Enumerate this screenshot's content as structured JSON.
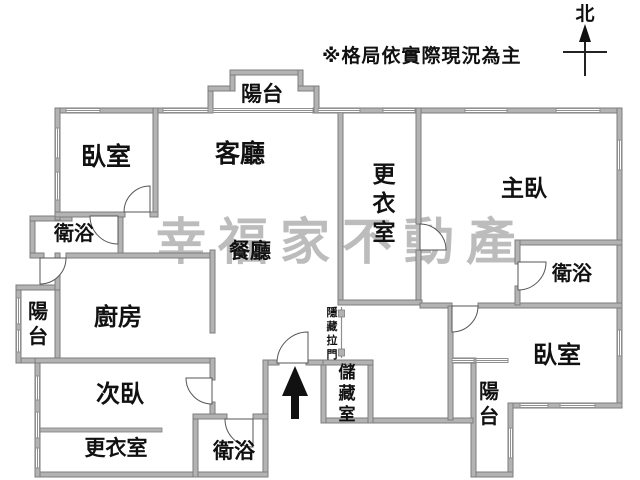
{
  "note": "※格局依實際現況為主",
  "compass": {
    "label": "北"
  },
  "watermark": "幸福家不動產",
  "colors": {
    "wall": "#b3b3b3",
    "wall_outline": "#7d7d7d",
    "text": "#111111",
    "watermark": "#bcbcbc",
    "background": "#ffffff"
  },
  "rooms": [
    {
      "id": "balcony-top",
      "label": "陽台",
      "x": 262,
      "y": 101,
      "fs": 21
    },
    {
      "id": "bedroom-top-left",
      "label": "臥室",
      "x": 106,
      "y": 165,
      "fs": 25
    },
    {
      "id": "living-room",
      "label": "客廳",
      "x": 240,
      "y": 162,
      "fs": 25
    },
    {
      "id": "walkin-closet-main",
      "label": "更衣室",
      "x": 384,
      "y": 182,
      "fs": 23,
      "vertical": true
    },
    {
      "id": "master-bedroom",
      "label": "主臥",
      "x": 524,
      "y": 196,
      "fs": 23
    },
    {
      "id": "bath-top-left",
      "label": "衛浴",
      "x": 74,
      "y": 240,
      "fs": 20
    },
    {
      "id": "dining-room",
      "label": "餐廳",
      "x": 250,
      "y": 258,
      "fs": 21
    },
    {
      "id": "balcony-left",
      "label": "陽台",
      "x": 38,
      "y": 318,
      "fs": 20,
      "vertical": true
    },
    {
      "id": "kitchen",
      "label": "廚房",
      "x": 118,
      "y": 325,
      "fs": 24
    },
    {
      "id": "bedroom-second",
      "label": "次臥",
      "x": 120,
      "y": 402,
      "fs": 24
    },
    {
      "id": "walkin-closet-second",
      "label": "更衣室",
      "x": 116,
      "y": 455,
      "fs": 21
    },
    {
      "id": "bath-bottom",
      "label": "衛浴",
      "x": 234,
      "y": 458,
      "fs": 21
    },
    {
      "id": "storage",
      "label": "儲藏室",
      "x": 347,
      "y": 378,
      "fs": 17,
      "vertical": true
    },
    {
      "id": "hidden-sliding-door",
      "label": "隱藏拉門",
      "x": 332,
      "y": 316,
      "fs": 11,
      "vertical": true
    },
    {
      "id": "bath-right",
      "label": "衛浴",
      "x": 572,
      "y": 280,
      "fs": 20
    },
    {
      "id": "bedroom-bottom-right",
      "label": "臥室",
      "x": 557,
      "y": 363,
      "fs": 24
    },
    {
      "id": "balcony-bottom-right",
      "label": "陽台",
      "x": 489,
      "y": 398,
      "fs": 20,
      "vertical": true
    }
  ]
}
